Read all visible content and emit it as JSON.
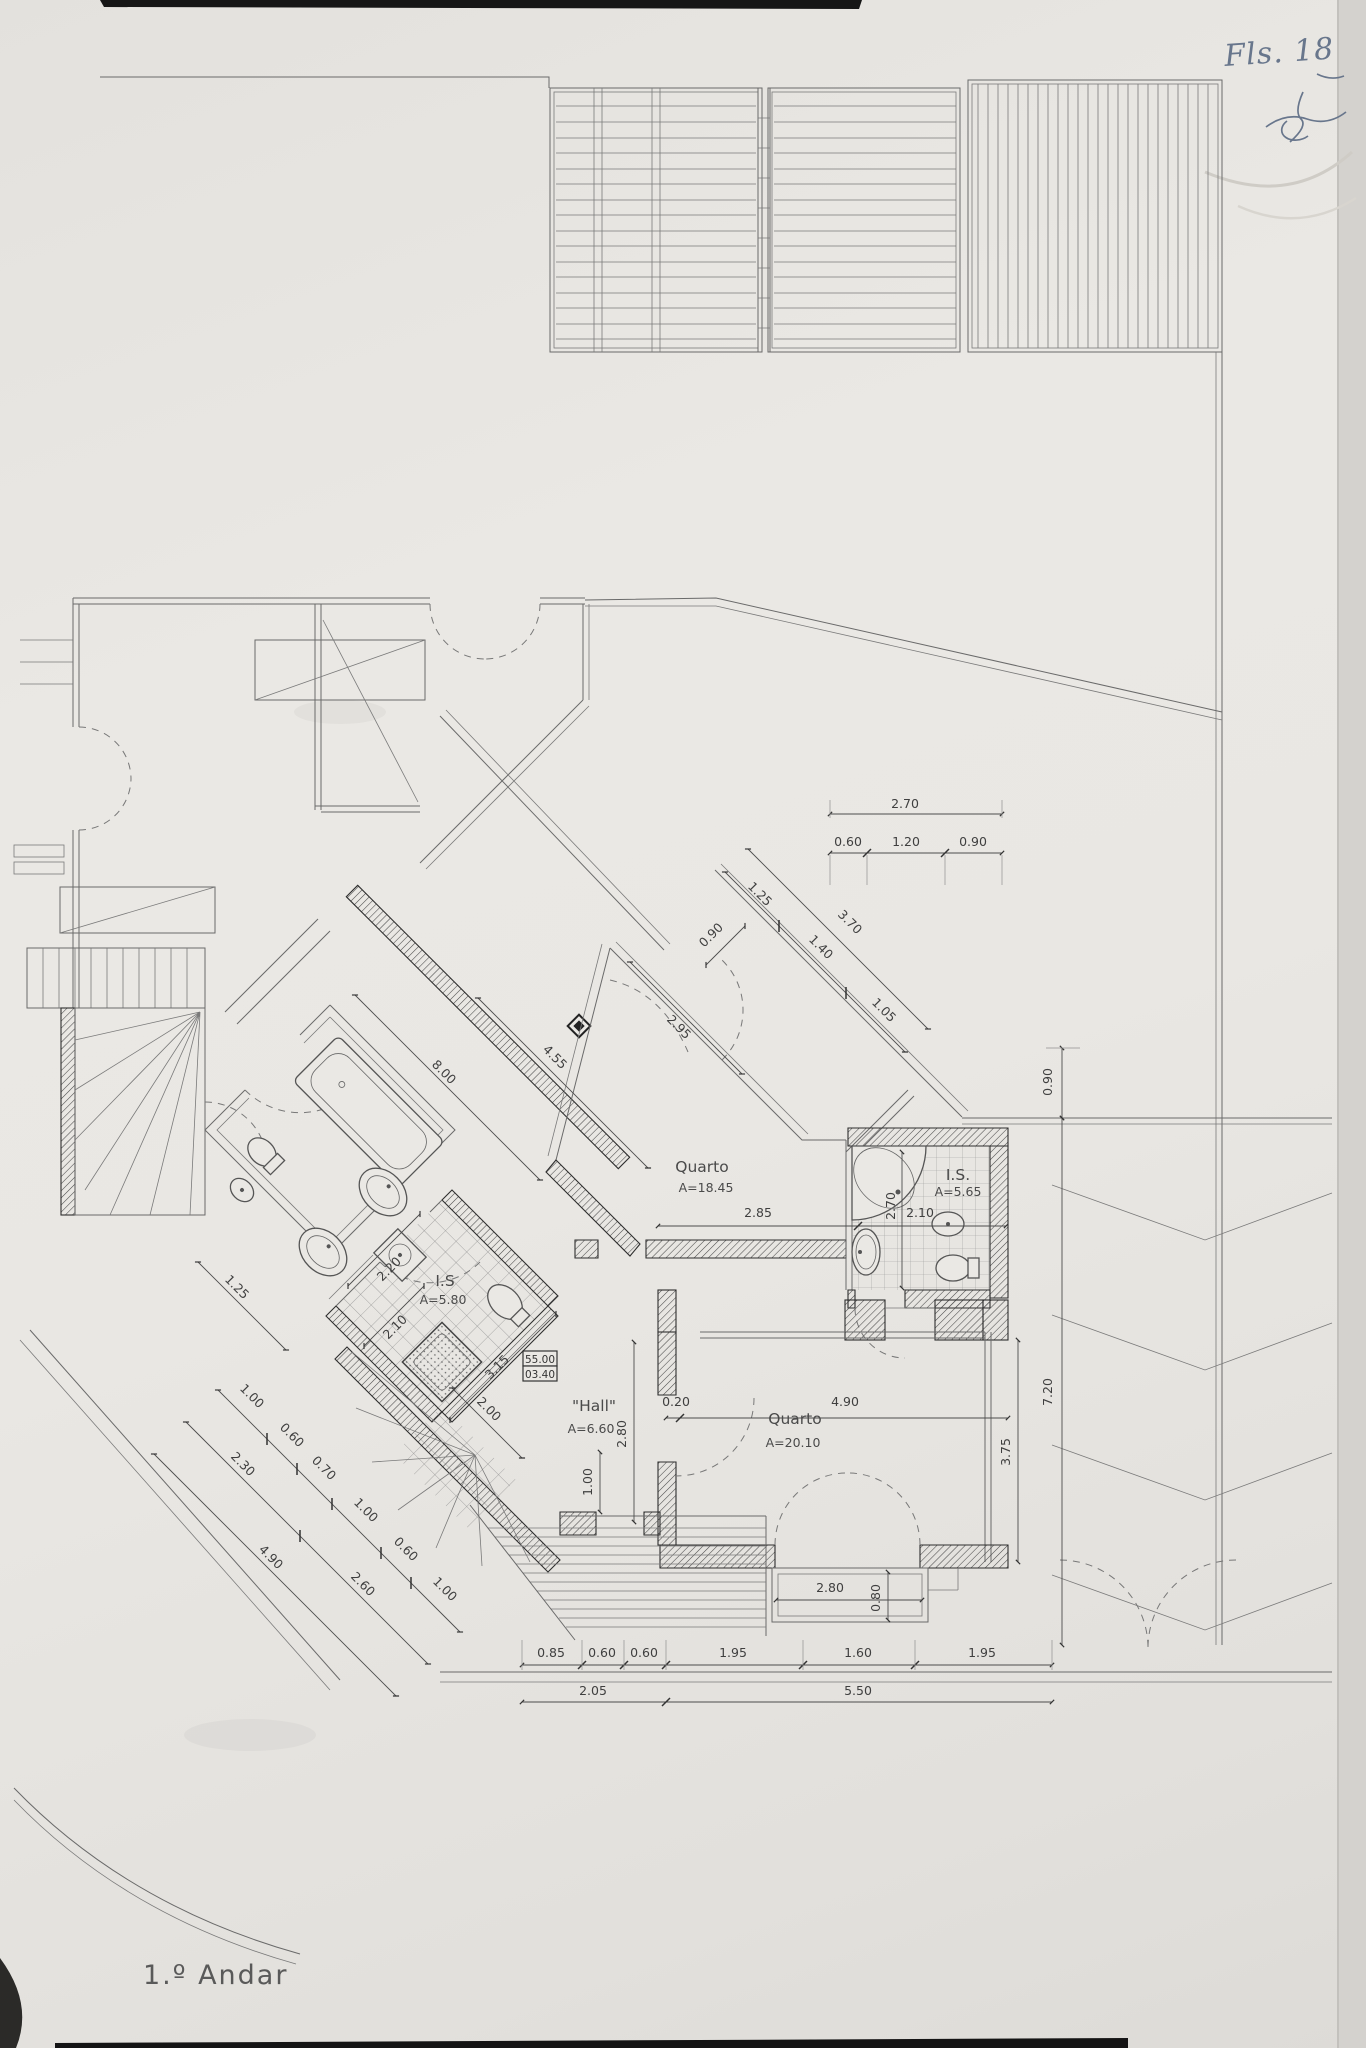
{
  "page": {
    "title": "1.º Andar",
    "folio_note": "Fls. 18"
  },
  "rooms": {
    "quarto1": {
      "name": "Quarto",
      "area": "A=18.45"
    },
    "is1": {
      "name": "I.S.",
      "area": "A=5.65"
    },
    "quarto2": {
      "name": "Quarto",
      "area": "A=20.10"
    },
    "hall": {
      "name": "\"Hall\"",
      "area": "A=6.60"
    },
    "is2": {
      "name": "I.S",
      "area": "A=5.80"
    }
  },
  "levels": {
    "upper": "55.00",
    "lower": "03.40"
  },
  "dims": {
    "top_total": "2.70",
    "top_a": "0.60",
    "top_b": "1.20",
    "top_c": "0.90",
    "diag_a": "1.25",
    "diag_total": "3.70",
    "diag_b": "1.40",
    "diag_c": "1.05",
    "diag_off": "0.90",
    "corr_len": "8.00",
    "corr_wall": "4.55",
    "q1_door": "2.95",
    "q1_w": "2.85",
    "is1_w": "2.10",
    "is1_h": "2.70",
    "q2_gap": "0.20",
    "q2_w": "4.90",
    "q2_h": "3.75",
    "hall_h": "2.80",
    "hall_w": "1.00",
    "land": "2.00",
    "is2_d": "3.15",
    "is2_a": "2.20",
    "is2_b": "2.10",
    "balc_w": "2.80",
    "balc_d": "0.80",
    "r_off": "0.90",
    "r_len": "7.20",
    "b1": [
      "0.85",
      "0.60",
      "0.60",
      "1.95",
      "1.60",
      "1.95"
    ],
    "b2_a": "2.05",
    "b2_b": "5.50",
    "l_chain": [
      "1.00",
      "0.60",
      "0.70",
      "1.00",
      "0.60",
      "1.00"
    ],
    "l_m1": "2.30",
    "l_m2": "2.60",
    "l_total": "4.90",
    "l_far": "1.25"
  }
}
